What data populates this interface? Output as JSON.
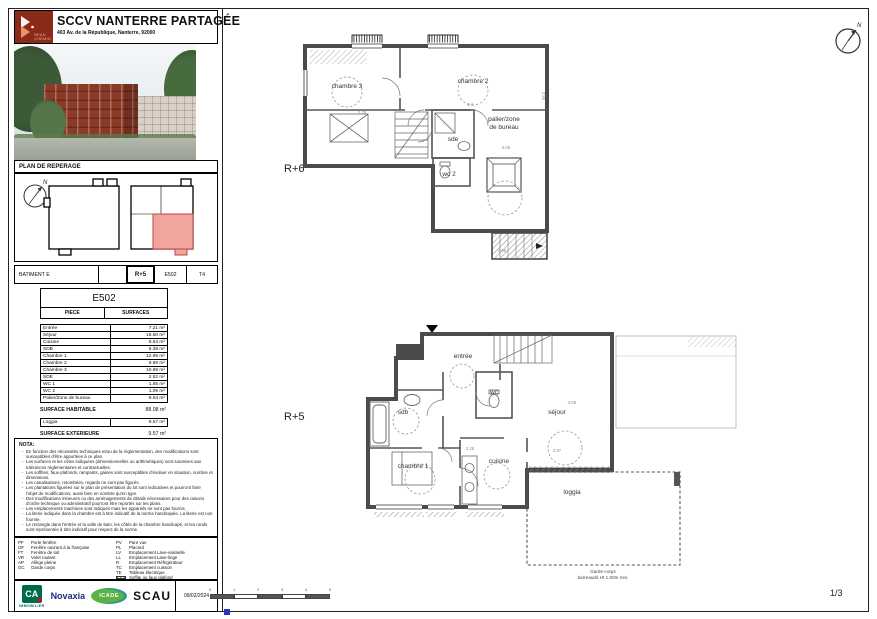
{
  "colors": {
    "highlight_pink": "#f2a49e",
    "logo_maroon": "#8c2a1a",
    "wall_gray": "#4b4b4b",
    "ca_green": "#006a4e",
    "novaxia_blue": "#1d2f7c",
    "icade_green": "#5cb245",
    "scau_black": "#111111",
    "blue_mark": "#2438b8"
  },
  "header": {
    "title": "SCCV NANTERRE PARTAGÉE",
    "subtitle": "403 Av. de la République, Nanterre, 92000",
    "logo_line1": "BEAU",
    "logo_line2": "CHEMIN"
  },
  "reperage": {
    "title": "PLAN DE REPERAGE",
    "north": "N"
  },
  "batiment_row": {
    "c1": "BATIMENT E",
    "c2": "",
    "c3": "R+5",
    "c4": "E502",
    "c5": "T4"
  },
  "surface_table": {
    "lot": "E502",
    "col_piece": "PIECE",
    "col_surfaces": "SURFACES",
    "rows": [
      {
        "piece": "Entrée",
        "surface": "7.21 m²"
      },
      {
        "piece": "Séjour",
        "surface": "18.60 m²"
      },
      {
        "piece": "Cuisine",
        "surface": "8.53 m²"
      },
      {
        "piece": "SDB",
        "surface": "5.38 m²"
      },
      {
        "piece": "Chambre 1",
        "surface": "12.99 m²"
      },
      {
        "piece": "Chambre 2",
        "surface": "9.88 m²"
      },
      {
        "piece": "Chambre 3",
        "surface": "10.89 m²"
      },
      {
        "piece": "SDE",
        "surface": "2.52 m²"
      },
      {
        "piece": "WC 1",
        "surface": "1.85 m²"
      },
      {
        "piece": "WC 2",
        "surface": "1.09 m²"
      },
      {
        "piece": "Palier/Zone de bureau",
        "surface": "9.04 m²"
      }
    ],
    "habitable_label": "SURFACE HABITABLE",
    "habitable_value": "88.08 m²",
    "ext_rows": [
      {
        "piece": "Loggia",
        "surface": "9.57 m²"
      }
    ],
    "exterieure_label": "SURFACE EXTERIEURE",
    "exterieure_value": "9.57 m²"
  },
  "nota": {
    "title": "NOTA:",
    "items": [
      "En fonction des nécessités techniques et/ou de la réglementation, des modifications sont susceptibles d'être apportées à ce plan.",
      "Les surfaces et les côtes indiquées (dimensionnelles ou arithmétiques) sont soumises aux tolérances réglementaires et contractuelles.",
      "Les soffites, faux-plafonds, rampants, gaines sont susceptibles d'évoluer en situation, nombre et dimensions.",
      "Les canalisations, retombées, regards ne sont pas figurés.",
      "Les plantations figurées sur le plan de présentation du lot sont indicatives et pourront faire l'objet de modifications, aussi bien en nombre qu'en type.",
      "Des modifications mineures ou des aménagements de détails nécessaires pour des raisons d'ordre technique ou administratif pourront être reportés sur les plans.",
      "Les emplacements machines sont indiqués mais les appareils ne sont pas fournis.",
      "La literie indiquée dans la chambre est à titre indicatif de la norme handicapée. La literie est non fournie.",
      "Le rectangle dans l'entrée et la salle de bain, les côtés de la chambre handicapé, et les ronds sont représentés à titre indicatif pour respect de la norme."
    ]
  },
  "legend": {
    "col1": [
      {
        "key": "PF",
        "label": "Porte fenêtre"
      },
      {
        "key": "OF",
        "label": "Fenêtre ouvrant à la française"
      },
      {
        "key": "FT",
        "label": "Fenêtre de toit"
      },
      {
        "key": "VR",
        "label": "Volet roulant"
      },
      {
        "key": "AP",
        "label": "Allège pleine"
      },
      {
        "key": "GC",
        "label": "Garde corps"
      }
    ],
    "col2": [
      {
        "key": "PV",
        "label": "Pare vue"
      },
      {
        "key": "PL",
        "label": "Placard"
      },
      {
        "key": "LV",
        "label": "Emplacement Lave-vaisselle"
      },
      {
        "key": "LL",
        "label": "Emplacement Lave-linge"
      },
      {
        "key": "R",
        "label": "Emplacement Réfrigérateur"
      },
      {
        "key": "TC",
        "label": "Emplacement cuisson"
      },
      {
        "key": "TE",
        "label": "Tableau électrique"
      },
      {
        "key": "",
        "swatch": true,
        "label": "Soffite ou faux plafond"
      }
    ]
  },
  "footer": {
    "date": "09/02/2024",
    "page": "1/3",
    "logos": {
      "ca": "CA",
      "ca_sub": "IMMOBILIER",
      "novaxia": "Novaxia",
      "icade": "ICADE",
      "scau": "SCAU"
    }
  },
  "scalebar": {
    "ticks": [
      "0",
      "1",
      "2",
      "3",
      "4",
      "5"
    ]
  },
  "plans": {
    "r6": {
      "label": "R+6",
      "rooms": [
        {
          "t": "chambre 3",
          "x": 347,
          "y": 88
        },
        {
          "t": "chambre 2",
          "x": 473,
          "y": 83
        },
        {
          "t": "palier/zone",
          "x": 504,
          "y": 121
        },
        {
          "t": "de bureau",
          "x": 504,
          "y": 129
        },
        {
          "t": "sde",
          "x": 453,
          "y": 141
        },
        {
          "t": "wc 2",
          "x": 449,
          "y": 176
        }
      ],
      "dims": [
        {
          "t": "2.76",
          "x": 362,
          "y": 114
        },
        {
          "t": "3.4",
          "x": 470,
          "y": 106
        },
        {
          "t": "2.66",
          "x": 506,
          "y": 149
        },
        {
          "t": "2.55",
          "x": 542,
          "y": 96,
          "r": 90
        },
        {
          "t": "2.96",
          "x": 502,
          "y": 252
        }
      ]
    },
    "r5": {
      "label": "R+5",
      "rooms": [
        {
          "t": "entrée",
          "x": 463,
          "y": 358
        },
        {
          "t": "wc",
          "x": 494,
          "y": 394
        },
        {
          "t": "sdb",
          "x": 403,
          "y": 414
        },
        {
          "t": "séjour",
          "x": 557,
          "y": 414
        },
        {
          "t": "cuisine",
          "x": 499,
          "y": 463
        },
        {
          "t": "chambre 1",
          "x": 413,
          "y": 468
        },
        {
          "t": "loggia",
          "x": 572,
          "y": 494
        }
      ],
      "dims": [
        {
          "t": "4.05",
          "x": 572,
          "y": 404
        },
        {
          "t": "3.97",
          "x": 557,
          "y": 452
        },
        {
          "t": "2.28",
          "x": 470,
          "y": 450
        }
      ],
      "garde_corps": [
        "Garde-corps",
        "barreaudé Ht 1.00m min."
      ]
    }
  }
}
